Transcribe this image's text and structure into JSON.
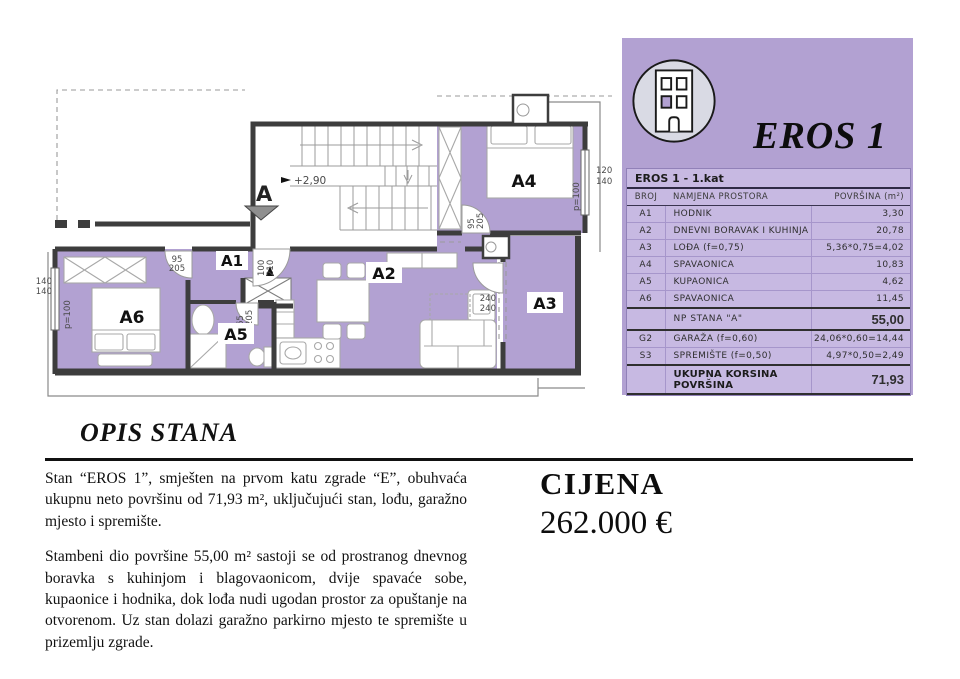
{
  "panel": {
    "title": "EROS 1",
    "table": {
      "header": "EROS 1 - 1.kat",
      "columns": [
        "BROJ",
        "NAMJENA PROSTORA",
        "POVRŠINA (m²)"
      ],
      "rows": [
        {
          "broj": "A1",
          "naziv": "HODNIK",
          "area": "3,30"
        },
        {
          "broj": "A2",
          "naziv": "DNEVNI BORAVAK I KUHINJA",
          "area": "20,78"
        },
        {
          "broj": "A3",
          "naziv": "LOĐA (f=0,75)",
          "area": "5,36*0,75=4,02"
        },
        {
          "broj": "A4",
          "naziv": "SPAVAONICA",
          "area": "10,83"
        },
        {
          "broj": "A5",
          "naziv": "KUPAONICA",
          "area": "4,62"
        },
        {
          "broj": "A6",
          "naziv": "SPAVAONICA",
          "area": "11,45"
        },
        {
          "broj": "",
          "naziv": "NP STANA \"A\"",
          "area": "55,00"
        },
        {
          "broj": "G2",
          "naziv": "GARAŽA (f=0,60)",
          "area": "24,06*0,60=14,44"
        },
        {
          "broj": "S3",
          "naziv": "SPREMIŠTE (f=0,50)",
          "area": "4,97*0,50=2,49"
        },
        {
          "broj": "",
          "naziv": "UKUPNA KORSINA POVRŠINA",
          "area": "71,93"
        }
      ]
    }
  },
  "plan": {
    "rooms": {
      "a1": "A1",
      "a2": "A2",
      "a3": "A3",
      "a4": "A4",
      "a5": "A5",
      "a6": "A6"
    },
    "marker": "A",
    "level": "+2,90",
    "dims": {
      "d95": "95",
      "d205": "205",
      "d65": "65",
      "d100": "100",
      "d210": "210",
      "d240": "240",
      "d120": "120",
      "d140": "140",
      "p100": "p=100"
    }
  },
  "description": {
    "heading": "OPIS STANA",
    "paragraphs": [
      "Stan “EROS 1”, smješten na prvom katu zgrade “E”, obuhvaća ukupnu neto površinu od 71,93 m², uključujući stan, lođu, garažno mjesto i spremište.",
      "Stambeni dio površine 55,00 m² sastoji se od prostranog dnevnog boravka s kuhinjom i blagovaonicom, dvije spavaće sobe, kupaonice i hodnika, dok lođa nudi ugodan prostor za opuštanje na otvorenom. Uz stan dolazi garažno parkirno mjesto te spremište u prizemlju zgrade.",
      ""
    ]
  },
  "price": {
    "label": "CIJENA",
    "value": "262.000 €"
  },
  "colors": {
    "purple": "#b2a1d2",
    "table_bg": "#c7b9e2",
    "wall": "#3d3d3d"
  }
}
